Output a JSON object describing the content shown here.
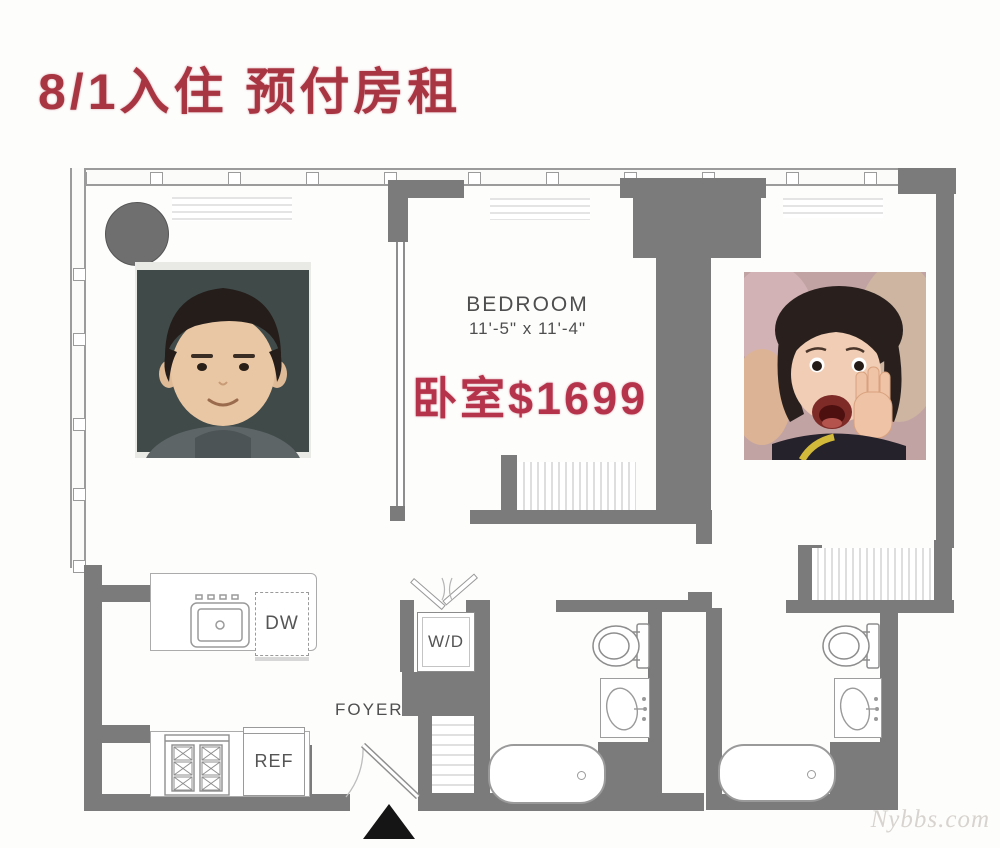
{
  "header": {
    "title": "8/1入住 预付房租"
  },
  "plan": {
    "bedroom": {
      "label": "BEDROOM",
      "dimensions": "11'-5\" x 11'-4\"",
      "price_note": "卧室$1699"
    },
    "kitchen": {
      "dishwasher": "DW",
      "refrigerator": "REF"
    },
    "laundry": {
      "washer_dryer": "W/D"
    },
    "foyer": {
      "label": "FOYER"
    }
  },
  "photos": {
    "left": "boy-meme-photo",
    "right": "girl-meme-photo"
  },
  "watermark": {
    "text": "Nybbs.com"
  },
  "colors": {
    "wall_gray": "#7b7b7b",
    "outline_gray": "#979797",
    "title_red": "#a83642",
    "price_red": "#b5344c"
  }
}
